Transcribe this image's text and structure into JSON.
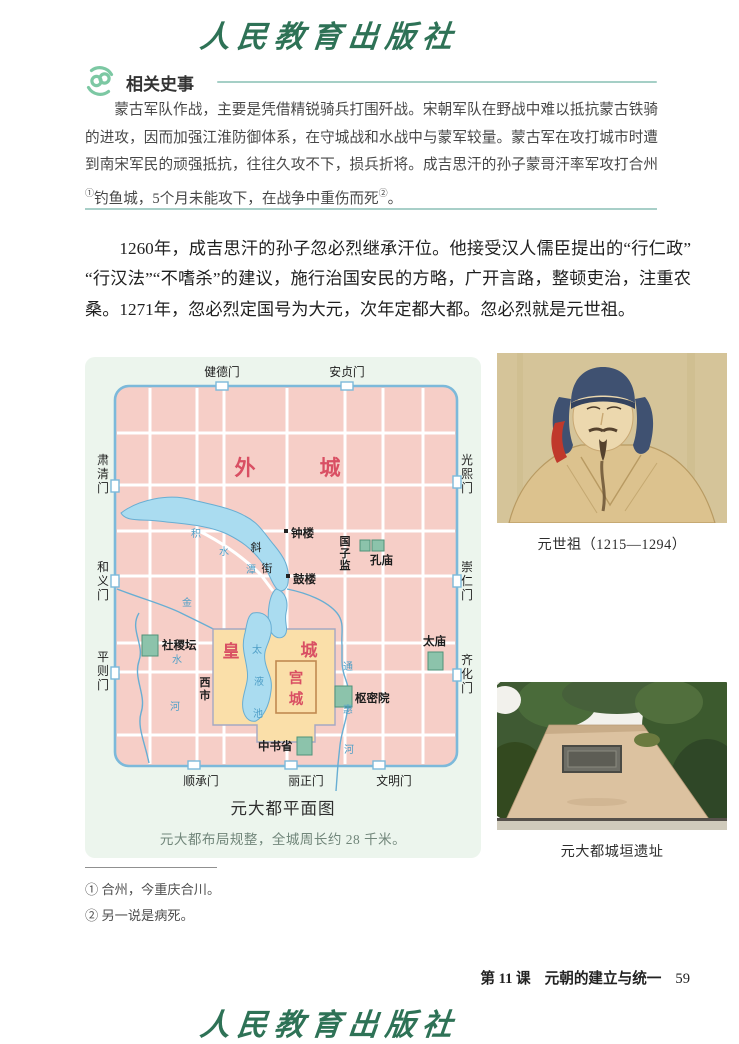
{
  "brand": {
    "publisher": "人民教育出版社"
  },
  "related_history": {
    "title": "相关史事",
    "body_segments": [
      "蒙古军队作战，主要是凭借精锐骑兵打围歼战。宋朝军队在野战中难以抵抗蒙古铁骑的进攻，因而加强江淮防御体系，在守城战和水战中与蒙军较量。蒙古军在攻打城市时遭到南宋军民的顽强抵抗，往往久攻不下，损兵折将。成吉思汗的孙子蒙哥汗率军攻打合州",
      "①",
      "钓鱼城，5个月未能攻下，在战争中重伤而死",
      "②",
      "。"
    ]
  },
  "main_text": "1260年，成吉思汗的孙子忽必烈继承汗位。他接受汉人儒臣提出的“行仁政”“行汉法”“不嗜杀”的建议，施行治国安民的方略，广开言路，整顿吏治，注重农桑。1271年，忽必烈定国号为大元，次年定都大都。忽必烈就是元世祖。",
  "map": {
    "caption": "元大都平面图",
    "note": "元大都布局规整，全城周长约 28 千米。",
    "gates": {
      "north": [
        "健德门",
        "安贞门"
      ],
      "south": [
        "顺承门",
        "丽正门",
        "文明门"
      ],
      "west": [
        "肃清门",
        "和义门",
        "平则门"
      ],
      "east": [
        "光熙门",
        "崇仁门",
        "齐化门"
      ]
    },
    "areas": {
      "outer_city": "外城",
      "imperial_city": "皇城",
      "palace_city": "宫城"
    },
    "landmarks": {
      "bell_tower": "钟楼",
      "drum_tower": "鼓楼",
      "xie_street": "斜街",
      "guozijian": "国子监",
      "confucius_temple": "孔庙",
      "sheji_altar": "社稷坛",
      "taimiao": "太庙",
      "shumiyuan": "枢密院",
      "zhongshusheng": "中书省",
      "west_market": "西市"
    },
    "waters": {
      "jishuitan": "积水潭",
      "taiyechi": "太液池",
      "jinshuihe": "金水河",
      "tonghuihe": "通惠河"
    },
    "colors": {
      "city_fill": "#f6cec7",
      "wall_stroke": "#7cb9da",
      "water_fill": "#aadcf0",
      "imperial_fill": "#fadfa9",
      "building_fill": "#8cc3ab",
      "red_label": "#d94f63",
      "panel_bg": "#ecf5ed"
    }
  },
  "portrait": {
    "caption": "元世祖（1215—1294）"
  },
  "ruins": {
    "caption": "元大都城垣遗址"
  },
  "footnotes": [
    {
      "marker": "①",
      "text": "合州，今重庆合川。"
    },
    {
      "marker": "②",
      "text": "另一说是病死。"
    }
  ],
  "footer": {
    "lesson": "第 11 课",
    "title": "元朝的建立与统一",
    "page_number": "59"
  }
}
